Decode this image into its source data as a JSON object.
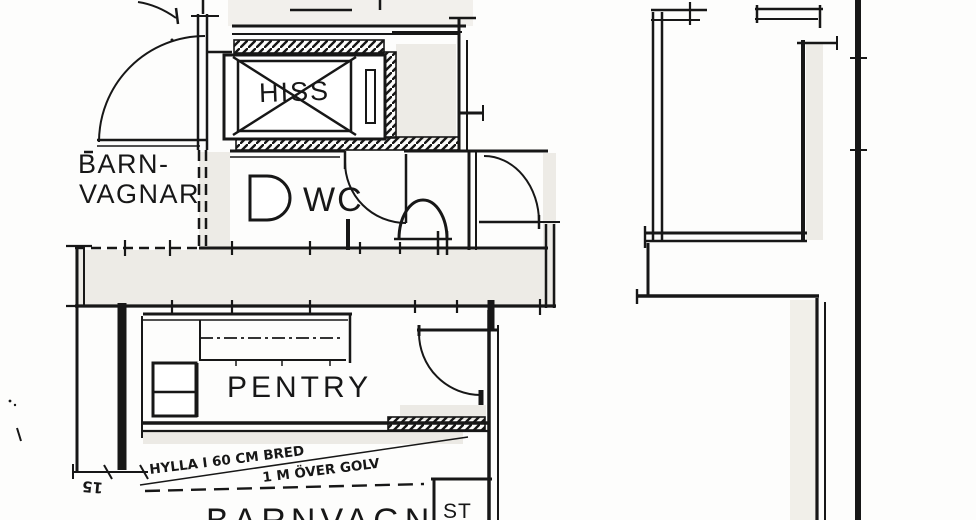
{
  "plan": {
    "type": "scanned-architectural-floor-plan",
    "rooms": [
      {
        "id": "hiss",
        "label": "HISS"
      },
      {
        "id": "barnvagnar",
        "line1": "BARN-",
        "line2": "VAGNAR"
      },
      {
        "id": "wc",
        "label": "WC"
      },
      {
        "id": "pentry",
        "label": "PENTRY"
      },
      {
        "id": "barnvagn",
        "label": "BARNVAGN"
      },
      {
        "id": "stad",
        "label": "ST"
      }
    ],
    "annotations": {
      "shelf_note_line1": "HYLLA I 60 CM BRED",
      "shelf_note_line2": "1 M ÖVER GOLV",
      "dimension": "15"
    },
    "colors": {
      "ink": "#171717",
      "paper": "#fdfdfc",
      "shade": "#ebe9e3"
    }
  }
}
